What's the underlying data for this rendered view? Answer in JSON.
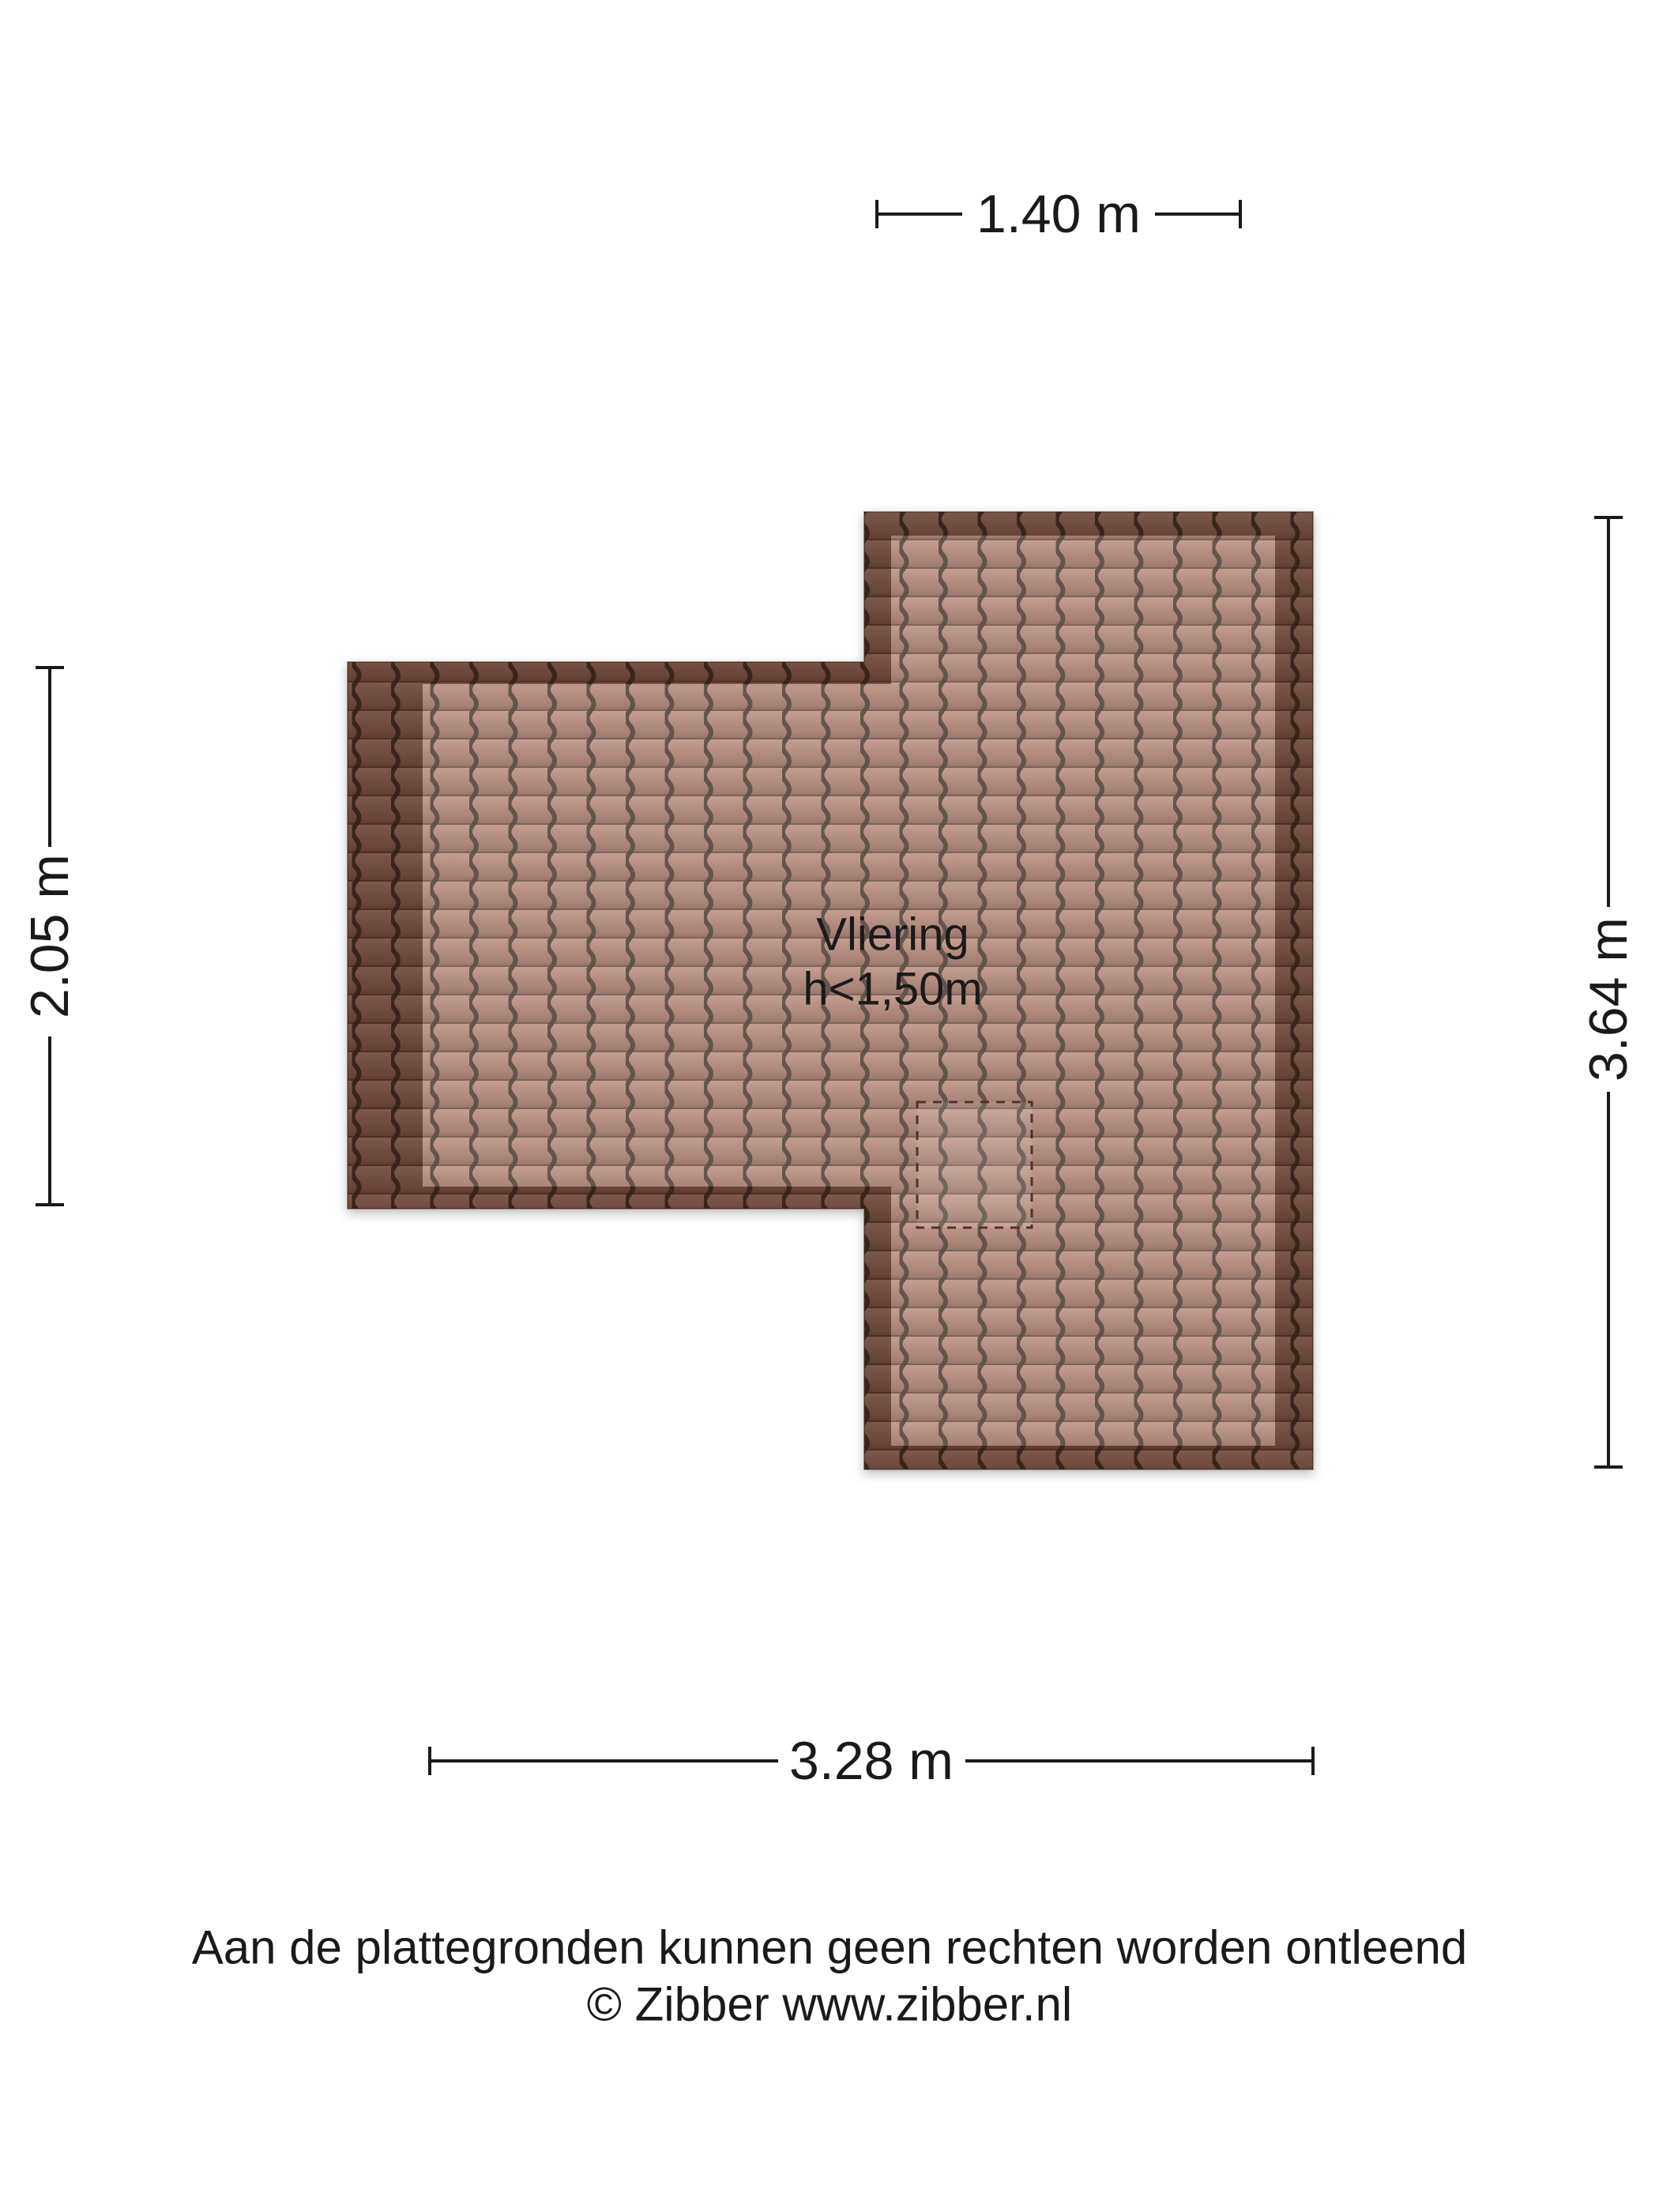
{
  "floor_plan": {
    "room": {
      "label": "Vliering",
      "height_note": "h<1,50m"
    },
    "dimensions": {
      "top": "1.40 m",
      "left": "2.05 m",
      "right": "3.64 m",
      "bottom": "3.28 m"
    },
    "colors": {
      "tile_base": "#a37768",
      "tile_joint": "#3a2b23",
      "roof_edge_shade": "#2a130c",
      "floor_highlight": "#ffffff",
      "hatch_outline": "#553129",
      "ink": "#1a1a1a"
    }
  },
  "footer": {
    "disclaimer": "Aan de plattegronden kunnen geen rechten worden ontleend",
    "copyright": "© Zibber www.zibber.nl"
  }
}
